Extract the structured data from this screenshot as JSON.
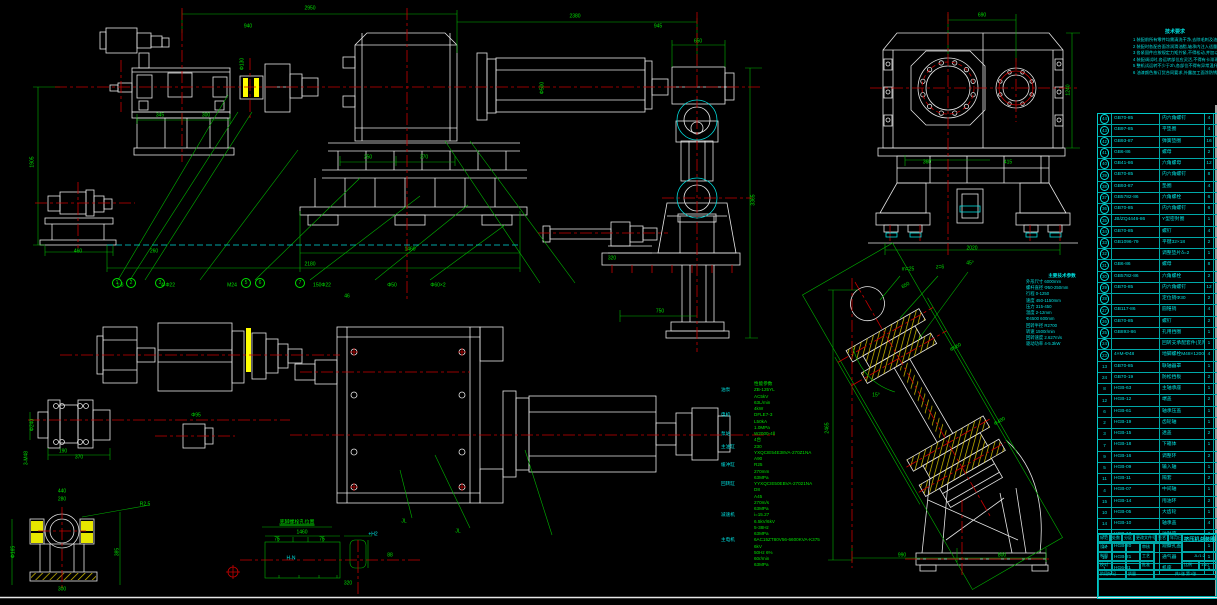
{
  "canvas": {
    "width": 1217,
    "height": 605,
    "background": "#000000"
  },
  "colors": {
    "line_white": "#e6e6e6",
    "dim_green": "#00c000",
    "text_green": "#00e000",
    "center_red": "#c80000",
    "text_cyan": "#00e0e0",
    "hatch_yellow": "#ffff00"
  },
  "notes": {
    "title": "技术要求",
    "lines": [
      "1 装配前所有零件均需清洗干净,去除毛刺及油污后方可装配",
      "2 装配时各配合面涂润滑油脂,轴承内注入适量润滑脂",
      "3 各紧固件应按规定力矩拧紧,不得松动,并加以防松处理",
      "4 装配调试时,各运转部位应灵活,不得有卡滞现象",
      "5 整机试运转不少于2h,各部位不得有异常温升及渗漏",
      "6 油漆颜色按订货合同要求,外露加工面涂防锈油"
    ]
  },
  "specs": {
    "rows": [
      {
        "l": "",
        "v": "性能参数"
      },
      {
        "l": "油泵",
        "v": "ZB-125YL"
      },
      {
        "l": "",
        "v": "AC5kV"
      },
      {
        "l": "",
        "v": "63L/min"
      },
      {
        "l": "",
        "v": "4kW"
      },
      {
        "l": "电机",
        "v": "DFLE7-3"
      },
      {
        "l": "",
        "v": "L50kA"
      },
      {
        "l": "",
        "v": "1.0MPa"
      },
      {
        "l": "泵站",
        "v": "W2000-4Ⅱ"
      },
      {
        "l": "",
        "v": "4台"
      },
      {
        "l": "主油缸",
        "v": "230"
      },
      {
        "l": "",
        "v": "YXQCIE54E38VA-270Z1NA"
      },
      {
        "l": "",
        "v": "A90"
      },
      {
        "l": "缓冲缸",
        "v": "R25"
      },
      {
        "l": "",
        "v": "270mm"
      },
      {
        "l": "",
        "v": "63MPa"
      },
      {
        "l": "回转缸",
        "v": "YYXQCIE50EBVA-27021NA"
      },
      {
        "l": "",
        "v": "D8"
      },
      {
        "l": "",
        "v": "A45"
      },
      {
        "l": "",
        "v": "270m/s"
      },
      {
        "l": "",
        "v": "63MPa"
      },
      {
        "l": "减速机",
        "v": "i=15.27"
      },
      {
        "l": "",
        "v": "6.5kV/6kV"
      },
      {
        "l": "",
        "v": "5-38Hz"
      },
      {
        "l": "",
        "v": "63MPa"
      },
      {
        "l": "主电机",
        "v": "6AC15ZT80V56-6600KVA-K375"
      },
      {
        "l": "",
        "v": "6kV"
      },
      {
        "l": "",
        "v": "50Hz 6%"
      },
      {
        "l": "",
        "v": "60r/min"
      },
      {
        "l": "",
        "v": "63MPa"
      }
    ]
  },
  "incline_specs": {
    "title": "主要技术参数",
    "lines": [
      "外形尺寸 6000mm",
      "螺杆直径 Φ50-250mm",
      "行程 0-1250",
      "速度 450-1150mm",
      "压力 315-450",
      "温度 2-12mm",
      "Φ4500 600mm",
      "回转半径 R2700",
      "转速 1500r/min",
      "回转速度 2.627m/s",
      "驱动功率 4-5.3kW"
    ]
  },
  "parts_table": {
    "rows": [
      {
        "no": "44",
        "code": "GB70-85",
        "name": "内六角螺钉",
        "qty": "4",
        "circ": 1
      },
      {
        "no": "43",
        "code": "GB97-85",
        "name": "平垫圈",
        "qty": "4",
        "circ": 1
      },
      {
        "no": "42",
        "code": "GB93-87",
        "name": "弹簧垫圈",
        "qty": "16",
        "circ": 1
      },
      {
        "no": "41",
        "code": "GB6-86",
        "name": "螺母",
        "qty": "2",
        "circ": 1
      },
      {
        "no": "40",
        "code": "GB41-86",
        "name": "六角螺母",
        "qty": "12",
        "circ": 1
      },
      {
        "no": "39",
        "code": "GB70-85",
        "name": "内六角螺钉",
        "qty": "8",
        "circ": 1
      },
      {
        "no": "38",
        "code": "GB93-87",
        "name": "垫圈",
        "qty": "4",
        "circ": 1
      },
      {
        "no": "37",
        "code": "GB5782-86",
        "name": "六角螺栓",
        "qty": "6",
        "circ": 1
      },
      {
        "no": "36",
        "code": "GB70-85",
        "name": "内六角螺钉",
        "qty": "6",
        "circ": 1
      },
      {
        "no": "35",
        "code": "JB/ZQ4446-86",
        "name": "Y型密封圈",
        "qty": "1",
        "circ": 1
      },
      {
        "no": "34",
        "code": "GB70-85",
        "name": "螺钉",
        "qty": "4",
        "circ": 1
      },
      {
        "no": "33",
        "code": "GB1096-79",
        "name": "平键32×18",
        "qty": "2",
        "circ": 1
      },
      {
        "no": "32",
        "code": "",
        "name": "调整垫片δ=2",
        "qty": "1",
        "circ": 1
      },
      {
        "no": "31",
        "code": "GB6-86",
        "name": "螺母",
        "qty": "8",
        "circ": 1
      },
      {
        "no": "30",
        "code": "GB5782-86",
        "name": "六角螺栓",
        "qty": "2",
        "circ": 1
      },
      {
        "no": "29",
        "code": "GB70-85",
        "name": "内六角螺钉",
        "qty": "12",
        "circ": 1
      },
      {
        "no": "28",
        "code": "",
        "name": "定位销Φ30",
        "qty": "2",
        "circ": 1
      },
      {
        "no": "27",
        "code": "GB117-86",
        "name": "圆锥销",
        "qty": "4",
        "circ": 1
      },
      {
        "no": "26",
        "code": "GB70-85",
        "name": "螺钉",
        "qty": "2",
        "circ": 1
      },
      {
        "no": "25",
        "code": "GB893-86",
        "name": "孔用挡圈",
        "qty": "1",
        "circ": 1
      },
      {
        "no": "24",
        "code": "",
        "name": "回转支承配套件(见附表)",
        "qty": "1",
        "circ": 1
      },
      {
        "no": "23",
        "code": "4×M-Φ48",
        "name": "地脚螺栓M48×1200(见基础图)",
        "qty": "4",
        "circ": 1
      },
      {
        "no": "13",
        "code": "GB70-85",
        "name": "联轴器罩",
        "qty": "1",
        "circ": 0
      },
      {
        "no": "24",
        "code": "GB70-19",
        "name": "防松挡板",
        "qty": "2",
        "circ": 0
      },
      {
        "no": "8",
        "code": "HGB-63",
        "name": "主轴承座",
        "qty": "1",
        "circ": 0
      },
      {
        "no": "12",
        "code": "HGB-12",
        "name": "端盖",
        "qty": "2",
        "circ": 0
      },
      {
        "no": "6",
        "code": "HGB-61",
        "name": "轴承压盖",
        "qty": "1",
        "circ": 0
      },
      {
        "no": "2",
        "code": "HGB-19",
        "name": "齿轮轴",
        "qty": "1",
        "circ": 0
      },
      {
        "no": "3",
        "code": "HGB-15",
        "name": "透盖",
        "qty": "2",
        "circ": 0
      },
      {
        "no": "7",
        "code": "HGB-18",
        "name": "下箱体",
        "qty": "1",
        "circ": 0
      },
      {
        "no": "9",
        "code": "HGB-16",
        "name": "调整环",
        "qty": "2",
        "circ": 0
      },
      {
        "no": "5",
        "code": "HGB-09",
        "name": "输入轴",
        "qty": "1",
        "circ": 0
      },
      {
        "no": "11",
        "code": "HGB-11",
        "name": "隔套",
        "qty": "2",
        "circ": 0
      },
      {
        "no": "4",
        "code": "HGB-07",
        "name": "中间轴",
        "qty": "1",
        "circ": 0
      },
      {
        "no": "15",
        "code": "HGB-14",
        "name": "甩油环",
        "qty": "2",
        "circ": 0
      },
      {
        "no": "10",
        "code": "HGB-05",
        "name": "大齿轮",
        "qty": "1",
        "circ": 0
      },
      {
        "no": "14",
        "code": "HGB-10",
        "name": "轴承盖",
        "qty": "4",
        "circ": 0
      },
      {
        "no": "16",
        "code": "HGB-13",
        "name": "油封座",
        "qty": "2",
        "circ": 0
      },
      {
        "no": "17",
        "code": "HGB-20",
        "name": "观察孔盖",
        "qty": "1",
        "circ": 0
      },
      {
        "no": "18",
        "code": "HGB-21",
        "name": "通气器",
        "qty": "1",
        "circ": 0
      },
      {
        "no": "1",
        "code": "HG6-01",
        "name": "机座",
        "qty": "1",
        "circ": 0
      }
    ]
  },
  "title_block": {
    "header": [
      "标记",
      "处数",
      "分区",
      "更改文件号",
      "签名",
      "年月日"
    ],
    "staff_left": [
      "设计",
      "制图",
      "校对"
    ],
    "staff_right": [
      "审核",
      "工艺",
      "批准"
    ],
    "drawing_title": "挤压机总装图",
    "drawing_code": "JL/1:2",
    "stage_label": "阶段标记",
    "mass_label": "质量",
    "scale_label": "比例",
    "scale_value": "1:10",
    "sheet_info": "共1张 第1张"
  },
  "dim_labels": [
    {
      "x": 310,
      "y": 9,
      "t": "2950"
    },
    {
      "x": 575,
      "y": 17,
      "t": "2380"
    },
    {
      "x": 248,
      "y": 27,
      "t": "940"
    },
    {
      "x": 658,
      "y": 27,
      "t": "945"
    },
    {
      "x": 33,
      "y": 162,
      "t": "1905",
      "r": -90
    },
    {
      "x": 243,
      "y": 64,
      "t": "Φ130",
      "r": -90
    },
    {
      "x": 160,
      "y": 116,
      "t": "345"
    },
    {
      "x": 206,
      "y": 116,
      "t": "300"
    },
    {
      "x": 368,
      "y": 158,
      "t": "250"
    },
    {
      "x": 424,
      "y": 158,
      "t": "370"
    },
    {
      "x": 543,
      "y": 88,
      "t": "Φ500",
      "r": -90
    },
    {
      "x": 410,
      "y": 250,
      "t": "1460"
    },
    {
      "x": 310,
      "y": 265,
      "t": "2180"
    },
    {
      "x": 78,
      "y": 252,
      "t": "460"
    },
    {
      "x": 154,
      "y": 252,
      "t": "260"
    },
    {
      "x": 120,
      "y": 286,
      "t": "1:8"
    },
    {
      "x": 168,
      "y": 286,
      "t": "4-Φ22"
    },
    {
      "x": 232,
      "y": 286,
      "t": "M24"
    },
    {
      "x": 322,
      "y": 286,
      "t": "150Φ22"
    },
    {
      "x": 392,
      "y": 286,
      "t": "Φ50"
    },
    {
      "x": 438,
      "y": 286,
      "t": "Φ60×2"
    },
    {
      "x": 347,
      "y": 297,
      "t": "46"
    },
    {
      "x": 698,
      "y": 42,
      "t": "650"
    },
    {
      "x": 754,
      "y": 200,
      "t": "3365",
      "r": -90
    },
    {
      "x": 660,
      "y": 312,
      "t": "750"
    },
    {
      "x": 612,
      "y": 259,
      "t": "320"
    },
    {
      "x": 982,
      "y": 16,
      "t": "690"
    },
    {
      "x": 1069,
      "y": 90,
      "t": "1240",
      "r": -90
    },
    {
      "x": 927,
      "y": 163,
      "t": "360"
    },
    {
      "x": 1008,
      "y": 163,
      "t": "415"
    },
    {
      "x": 972,
      "y": 249,
      "t": "2020"
    },
    {
      "x": 79,
      "y": 458,
      "t": "370"
    },
    {
      "x": 63,
      "y": 452,
      "t": "190"
    },
    {
      "x": 33,
      "y": 425,
      "t": "Φ240",
      "r": -90
    },
    {
      "x": 27,
      "y": 458,
      "t": "3-M48",
      "r": -90
    },
    {
      "x": 196,
      "y": 416,
      "t": "Φ95"
    },
    {
      "x": 297,
      "y": 523,
      "t": "底脚螺栓孔位置",
      "c": "g",
      "u": 1
    },
    {
      "x": 302,
      "y": 533,
      "t": "1460"
    },
    {
      "x": 277,
      "y": 540,
      "t": "75"
    },
    {
      "x": 322,
      "y": 540,
      "t": "75"
    },
    {
      "x": 373,
      "y": 535,
      "t": "+H2",
      "c": "c"
    },
    {
      "x": 291,
      "y": 559,
      "t": "H-N",
      "c": "c"
    },
    {
      "x": 390,
      "y": 556,
      "t": "88"
    },
    {
      "x": 348,
      "y": 584,
      "t": "320"
    },
    {
      "x": 404,
      "y": 522,
      "t": "JL"
    },
    {
      "x": 458,
      "y": 532,
      "t": "JL"
    },
    {
      "x": 62,
      "y": 492,
      "t": "440"
    },
    {
      "x": 62,
      "y": 500,
      "t": "280"
    },
    {
      "x": 145,
      "y": 505,
      "t": "R2.5"
    },
    {
      "x": 14,
      "y": 552,
      "t": "Φ165",
      "r": -90
    },
    {
      "x": 118,
      "y": 552,
      "t": "385",
      "r": -90
    },
    {
      "x": 62,
      "y": 590,
      "t": "300"
    },
    {
      "x": 906,
      "y": 286,
      "t": "650",
      "r": -30
    },
    {
      "x": 956,
      "y": 348,
      "t": "Φ560",
      "r": -30
    },
    {
      "x": 1000,
      "y": 422,
      "t": "Φ480",
      "r": -30
    },
    {
      "x": 828,
      "y": 428,
      "t": "2465",
      "r": -90
    },
    {
      "x": 902,
      "y": 556,
      "t": "990"
    },
    {
      "x": 1002,
      "y": 556,
      "t": "800"
    },
    {
      "x": 876,
      "y": 396,
      "t": "15°"
    },
    {
      "x": 908,
      "y": 270,
      "t": "m=25"
    },
    {
      "x": 940,
      "y": 268,
      "t": "z=6"
    },
    {
      "x": 970,
      "y": 264,
      "t": "45°"
    }
  ],
  "balloons": [
    {
      "x": 117,
      "y": 283,
      "n": "1"
    },
    {
      "x": 131,
      "y": 283,
      "n": "2"
    },
    {
      "x": 160,
      "y": 283,
      "n": "3"
    },
    {
      "x": 246,
      "y": 283,
      "n": "5"
    },
    {
      "x": 260,
      "y": 283,
      "n": "6"
    },
    {
      "x": 300,
      "y": 283,
      "n": "7"
    }
  ]
}
